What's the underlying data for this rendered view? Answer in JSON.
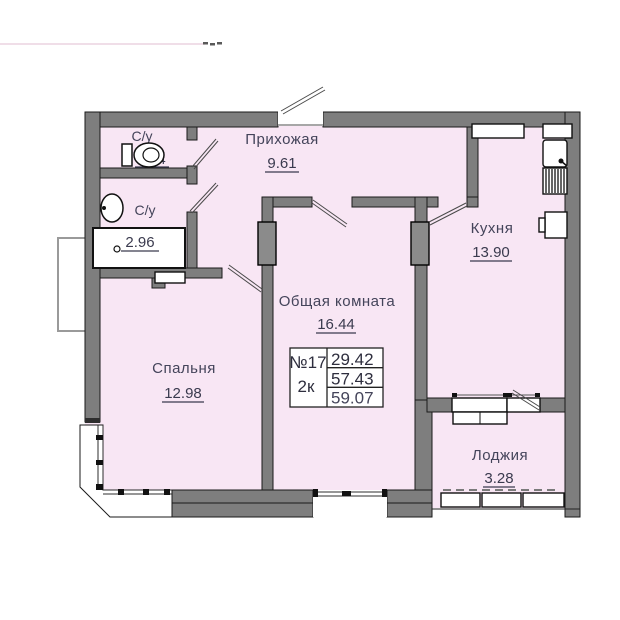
{
  "plan": {
    "type_label": "floor-plan",
    "rooms": [
      {
        "label": "С/у",
        "area": "1.54"
      },
      {
        "label": "С/у",
        "area": "2.96"
      },
      {
        "label": "Прихожая",
        "area": "9.61"
      },
      {
        "label": "Кухня",
        "area": "13.90"
      },
      {
        "label": "Общая комната",
        "area": "16.44"
      },
      {
        "label": "Спальня",
        "area": "12.98"
      },
      {
        "label": "Лоджия",
        "area": "3.28"
      }
    ],
    "info_box": {
      "unit_number": "№17",
      "unit_type": "2к",
      "living_area": "29.42",
      "area_no_loggia": "57.43",
      "total_area": "59.07"
    }
  },
  "colors": {
    "room_fill": "#f8e6f4",
    "wall_fill": "#7e7e7e",
    "wall_stroke": "#1a1a1a",
    "label_text": "#44445a",
    "total_area_red": "#e8342b",
    "top_decor_line": "#ecd4e0"
  }
}
